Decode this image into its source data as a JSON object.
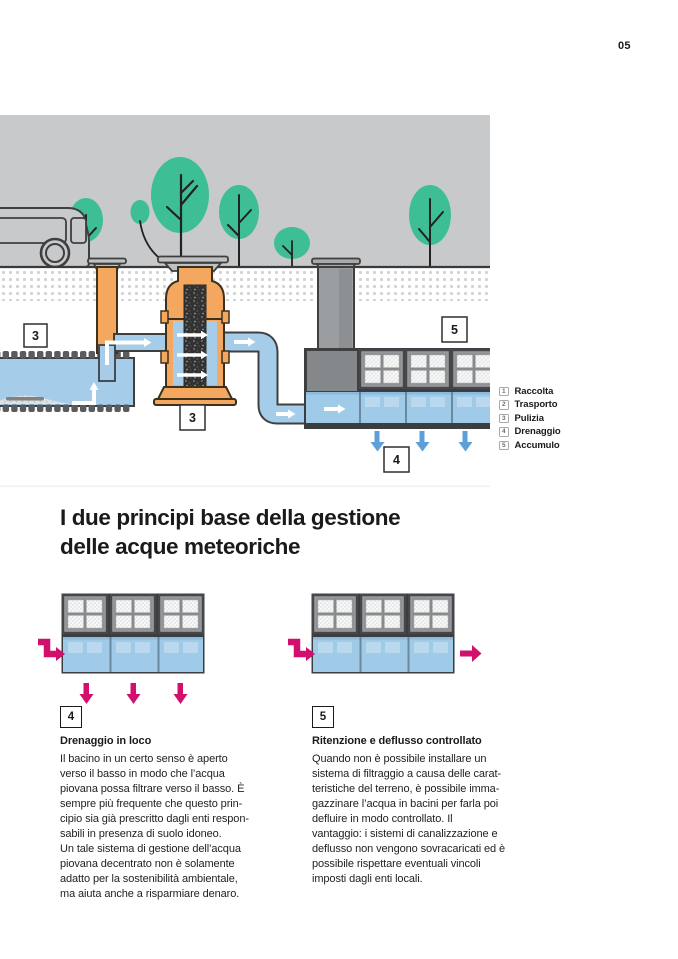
{
  "page": {
    "number": "05"
  },
  "colors": {
    "sky": "#c8c9ca",
    "tree_green": "#3dbe95",
    "pipe_orange": "#f4a75e",
    "water_blue": "#a5cde9",
    "tank_blue": "#9fcbe8",
    "magenta_accent": "#d30f6e",
    "arrow_blue": "#5d9fd8"
  },
  "illustration": {
    "labels": {
      "basin": "3",
      "filter": "3",
      "drain": "4",
      "storage": "5"
    }
  },
  "legend": {
    "items": [
      {
        "num": "1",
        "label": "Raccolta"
      },
      {
        "num": "2",
        "label": "Trasporto"
      },
      {
        "num": "3",
        "label": "Pulizia"
      },
      {
        "num": "4",
        "label": "Drenaggio"
      },
      {
        "num": "5",
        "label": "Accumulo"
      }
    ]
  },
  "heading": {
    "lines": [
      "I due principi base della gestione",
      "delle acque meteoriche"
    ]
  },
  "sections": {
    "left": {
      "badge": "4",
      "title": "Drenaggio in loco",
      "body": [
        "Il bacino in un certo senso è aperto",
        "verso il basso in modo che l’acqua",
        "piovana possa filtrare verso il basso. È",
        "sempre più frequente che questo prin-",
        "cipio sia già prescritto dagli enti respon-",
        "sabili in presenza di suolo idoneo.",
        "Un tale sistema di gestione dell’acqua",
        "piovana decentrato non è solamente",
        "adatto per la sostenibilità ambientale,",
        "ma aiuta anche a risparmiare denaro."
      ]
    },
    "right": {
      "badge": "5",
      "title": "Ritenzione e deflusso controllato",
      "body": [
        "Quando non è possibile installare un",
        "sistema di filtraggio a causa delle carat-",
        "teristiche del terreno, è possibile imma-",
        "gazzinare l’acqua in bacini per farla poi",
        "defluire in modo controllato. Il",
        "vantaggio: i sistemi di canalizzazione e",
        "deflusso non vengono sovracaricati ed è",
        "possibile rispettare eventuali vincoli",
        "imposti dagli enti locali."
      ]
    }
  }
}
